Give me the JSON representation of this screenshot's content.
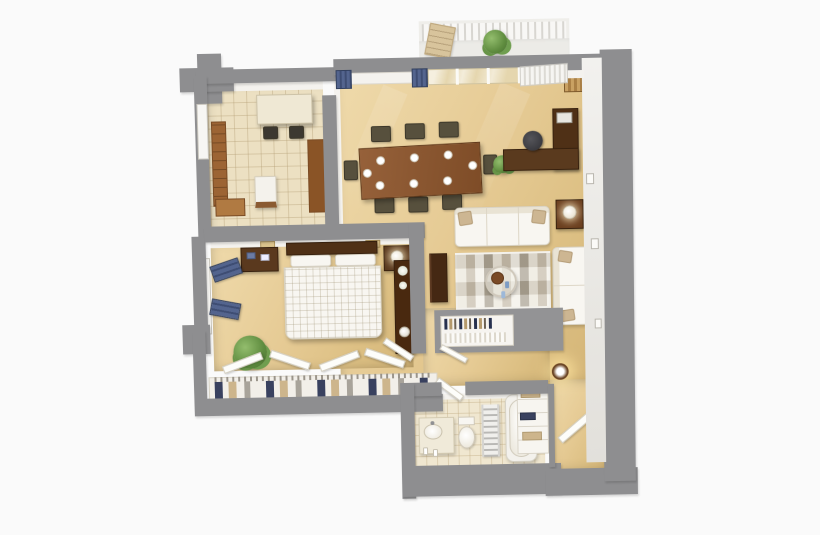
{
  "meta": {
    "title": "3D isometric floor plan render of a one-bedroom apartment with balcony",
    "view": "top-down-3d",
    "background": "#fafafa"
  },
  "palette": {
    "wall_gray": "#8e8e90",
    "wall_inner_face": "#f4f2ee",
    "carpet_beige": "#e3c790",
    "kitchen_tile": "#ece0c2",
    "bath_tile": "#f0e7d0",
    "wood_mid": "#9c6434",
    "wood_dark": "#4f3016",
    "accent_blue": "#53648e",
    "navy_clothes": "#39415f",
    "upholstery_white": "#f8f6f1",
    "rug_taupe": "#c6bcab",
    "plant_green": "#6f9e4f",
    "lamp_glow": "#ffe9b0"
  },
  "rooms": [
    {
      "name": "balcony",
      "items": [
        "white-railing",
        "lounge-chair",
        "potted-plant"
      ]
    },
    {
      "name": "kitchen",
      "items": [
        "breakfast-table",
        "two-chairs",
        "left-wall-cabinets",
        "island-counter",
        "tall-cabinet",
        "window",
        "tile-floor"
      ]
    },
    {
      "name": "dining-area",
      "items": [
        "dining-table",
        "eight-chairs",
        "place-settings",
        "blue-curtain-window",
        "sliding-glass-door",
        "vertical-blinds",
        "floor-plant"
      ]
    },
    {
      "name": "office-nook",
      "items": [
        "l-shaped-desk",
        "monitor",
        "office-chair",
        "wall-shelf-books"
      ]
    },
    {
      "name": "living-area",
      "items": [
        "three-seat-sofa",
        "loveseat",
        "striped-rug",
        "round-coffee-table",
        "side-table-with-lamp",
        "tv-console",
        "wall-frames"
      ]
    },
    {
      "name": "bedroom",
      "items": [
        "double-bed-checked-duvet",
        "headboard",
        "two-nightstands",
        "table-lamp",
        "blue-curtain-window",
        "potted-plant",
        "tall-dresser",
        "door"
      ]
    },
    {
      "name": "closet",
      "items": [
        "bifold-doors",
        "hanging-clothes-navy-tan-gray",
        "hanger-rod"
      ]
    },
    {
      "name": "hallway",
      "items": [
        "half-wall-bookcase",
        "door"
      ]
    },
    {
      "name": "bathroom",
      "items": [
        "vanity-with-round-sink",
        "toilet",
        "towel-radiator",
        "bathtub",
        "door",
        "tile-floor"
      ]
    },
    {
      "name": "entry",
      "items": [
        "entry-door",
        "linen-closet-shelves",
        "wall-sconce-light",
        "picture-frames"
      ]
    }
  ]
}
